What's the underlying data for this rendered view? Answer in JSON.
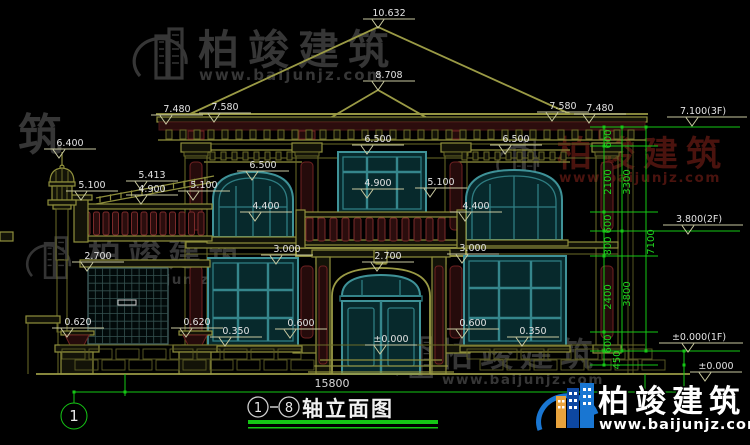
{
  "watermark": {
    "brand": "柏竣建筑",
    "url": "www.baijunjz.com",
    "fragment": "筑"
  },
  "logo": {
    "brand": "柏竣建筑",
    "url": "www.baijunjz.com"
  },
  "title_block": {
    "axis_start": "1",
    "axis_end": "8",
    "name": "轴立面图"
  },
  "axis_bubble": {
    "label": "1"
  },
  "dimensions": {
    "total_width": "15800",
    "right_chain_total": "7100",
    "vertical_dims": [
      {
        "t": "600",
        "x": 611,
        "y": 139
      },
      {
        "t": "2100",
        "x": 611,
        "y": 182
      },
      {
        "t": "600",
        "x": 611,
        "y": 224
      },
      {
        "t": "800",
        "x": 611,
        "y": 246
      },
      {
        "t": "2400",
        "x": 611,
        "y": 297
      },
      {
        "t": "600",
        "x": 611,
        "y": 344
      },
      {
        "t": "450",
        "x": 620,
        "y": 360
      },
      {
        "t": "3300",
        "x": 630,
        "y": 182
      },
      {
        "t": "3800",
        "x": 630,
        "y": 294
      },
      {
        "t": "7100",
        "x": 654,
        "y": 242
      }
    ]
  },
  "elevation_markers": [
    {
      "t": "10.632",
      "x": 389,
      "y": 16
    },
    {
      "t": "8.708",
      "x": 389,
      "y": 78
    },
    {
      "t": "7.480",
      "x": 177,
      "y": 112
    },
    {
      "t": "7.580",
      "x": 225,
      "y": 110
    },
    {
      "t": "7.580",
      "x": 563,
      "y": 109
    },
    {
      "t": "7.480",
      "x": 600,
      "y": 111
    },
    {
      "t": "7.100(3F)",
      "x": 703,
      "y": 114,
      "wl": 36,
      "wr": 44
    },
    {
      "t": "6.400",
      "x": 70,
      "y": 146
    },
    {
      "t": "5.413",
      "x": 152,
      "y": 178
    },
    {
      "t": "4.900",
      "x": 152,
      "y": 192
    },
    {
      "t": "5.100",
      "x": 92,
      "y": 188
    },
    {
      "t": "5.100",
      "x": 204,
      "y": 188
    },
    {
      "t": "6.500",
      "x": 263,
      "y": 168
    },
    {
      "t": "4.400",
      "x": 266,
      "y": 209
    },
    {
      "t": "3.000",
      "x": 287,
      "y": 252
    },
    {
      "t": "6.500",
      "x": 378,
      "y": 142
    },
    {
      "t": "4.900",
      "x": 378,
      "y": 186
    },
    {
      "t": "5.100",
      "x": 441,
      "y": 185
    },
    {
      "t": "2.700",
      "x": 388,
      "y": 259
    },
    {
      "t": "6.500",
      "x": 516,
      "y": 142
    },
    {
      "t": "4.400",
      "x": 476,
      "y": 209
    },
    {
      "t": "3.000",
      "x": 473,
      "y": 251
    },
    {
      "t": "2.700",
      "x": 98,
      "y": 259
    },
    {
      "t": "0.620",
      "x": 78,
      "y": 325
    },
    {
      "t": "0.620",
      "x": 197,
      "y": 325
    },
    {
      "t": "0.350",
      "x": 236,
      "y": 334
    },
    {
      "t": "0.600",
      "x": 301,
      "y": 326
    },
    {
      "t": "±0.000",
      "x": 391,
      "y": 342
    },
    {
      "t": "0.600",
      "x": 473,
      "y": 326
    },
    {
      "t": "0.350",
      "x": 533,
      "y": 334
    },
    {
      "t": "3.800(2F)",
      "x": 699,
      "y": 222,
      "wl": 36,
      "wr": 44
    },
    {
      "t": "±0.000(1F)",
      "x": 699,
      "y": 340,
      "wl": 40,
      "wr": 44
    },
    {
      "t": "±0.000",
      "x": 716,
      "y": 369
    }
  ]
}
